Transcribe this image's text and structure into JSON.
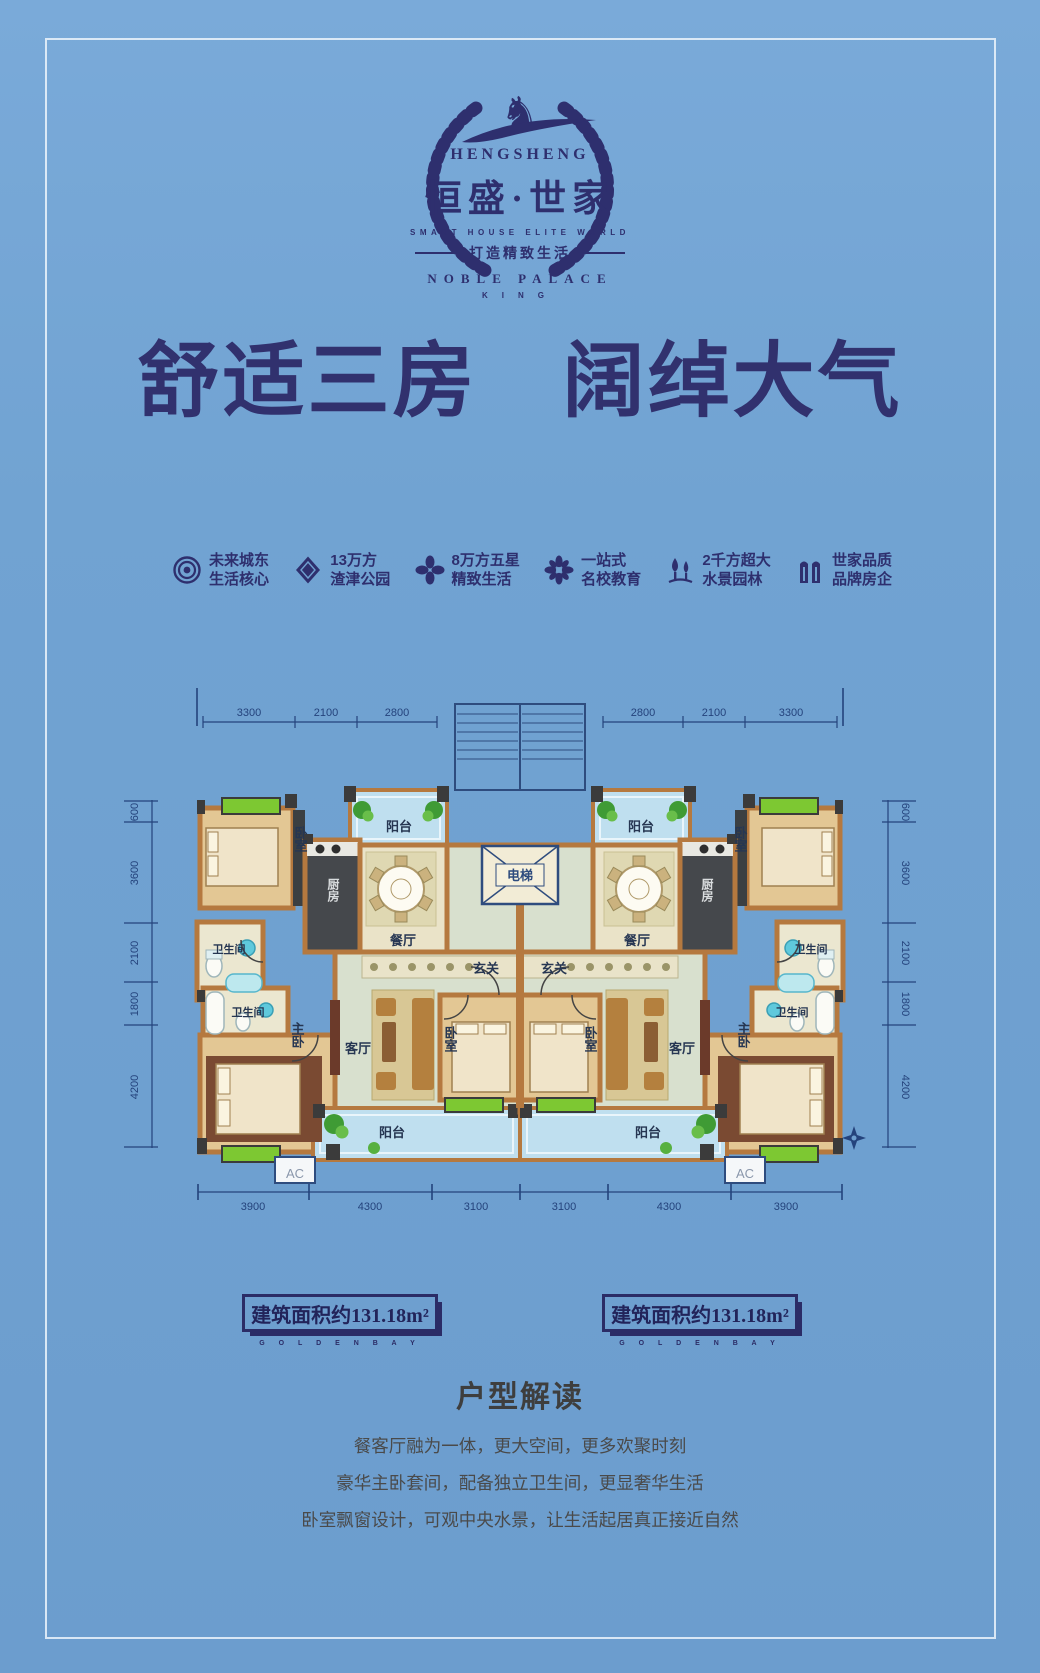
{
  "colors": {
    "background_blue": "#6FA0D0",
    "brand_navy": "#2E2F6E",
    "dimension_navy": "#24437C",
    "wall_tan": "#B5793F",
    "floor_sage": "#D8E0CE",
    "balcony_blue": "#BFDFEF",
    "bay_window_green": "#7DC832"
  },
  "logo": {
    "horse_icon": "♞",
    "brand_en": "HENGSHENG",
    "brand_cn": "恒盛·世家",
    "subtitle_en": "SMART HOUSE ELITE WORLD",
    "slogan_cn": "打造精致生活",
    "palace_en": "NOBLE PALACE",
    "king_en": "KING"
  },
  "headline": "舒适三房　阔绰大气",
  "features": [
    {
      "icon": "target-icon",
      "line1": "未来城东",
      "line2": "生活核心"
    },
    {
      "icon": "gem-icon",
      "line1": "13万方",
      "line2": "渣津公园"
    },
    {
      "icon": "clover-icon",
      "line1": "8万方五星",
      "line2": "精致生活"
    },
    {
      "icon": "flower-icon",
      "line1": "一站式",
      "line2": "名校教育"
    },
    {
      "icon": "fountain-icon",
      "line1": "2千方超大",
      "line2": "水景园林"
    },
    {
      "icon": "buildings-icon",
      "line1": "世家品质",
      "line2": "品牌房企"
    }
  ],
  "floorplan": {
    "room_labels": {
      "bedroom": "卧室",
      "kitchen": "厨房",
      "balcony": "阳台",
      "dining": "餐厅",
      "elevator": "电梯",
      "entry": "玄关",
      "bathroom": "卫生间",
      "master": "主卧",
      "living": "客厅",
      "ac": "AC"
    },
    "dims_top_left": [
      "3300",
      "2100",
      "2800"
    ],
    "dims_top_right": [
      "2800",
      "2100",
      "3300"
    ],
    "dims_left": [
      "600",
      "3600",
      "2100",
      "1800",
      "4200"
    ],
    "dims_right": [
      "600",
      "3600",
      "2100",
      "1800",
      "4200"
    ],
    "dims_bottom": [
      "3900",
      "4300",
      "3100",
      "3100",
      "4300",
      "3900"
    ]
  },
  "area_badges": [
    {
      "label": "建筑面积约131.18m²",
      "sub": "G O L D E N B A Y"
    },
    {
      "label": "建筑面积约131.18m²",
      "sub": "G O L D E N B A Y"
    }
  ],
  "analysis": {
    "title": "户型解读",
    "lines": [
      "餐客厅融为一体，更大空间，更多欢聚时刻",
      "豪华主卧套间，配备独立卫生间，更显奢华生活",
      "卧室飘窗设计，可观中央水景，让生活起居真正接近自然"
    ]
  }
}
